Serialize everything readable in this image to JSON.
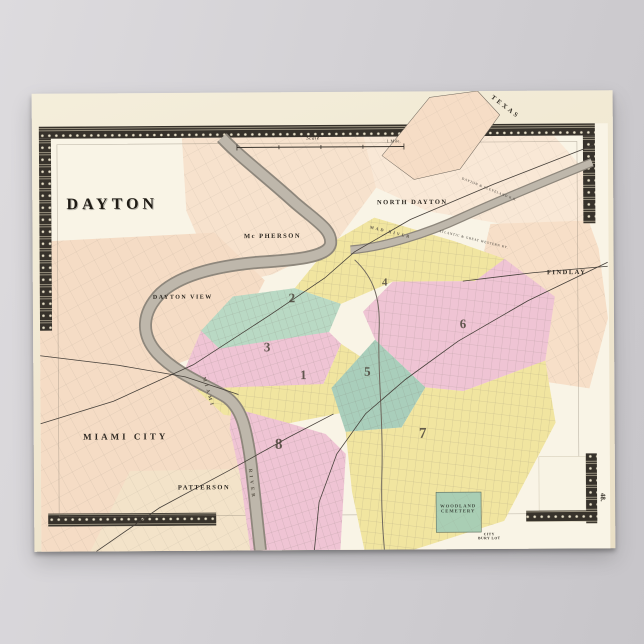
{
  "map": {
    "title": "DAYTON",
    "page_number": "48.",
    "scale": {
      "label": "Scale",
      "unit": "1 Mile."
    },
    "districts": {
      "mcpherson": "Mc PHERSON",
      "north_dayton": "NORTH DAYTON",
      "texas": "TEXAS",
      "findlay": "FINDLAY",
      "dayton_view": "DAYTON VIEW",
      "miami_city": "MIAMI CITY",
      "patterson": "PATTERSON",
      "woodland_cemetery": "WOODLAND CEMETERY",
      "city_bury_lot": "CITY BURY LOT"
    },
    "waterways": {
      "miami": "MIAMI",
      "river": "RIVER",
      "mad_river": "MAD RIVER"
    },
    "railroads": {
      "dayton_cleveland": "DAYTON & CLEVELAND R.R.",
      "atlantic_great_western": "ATLANTIC & GREAT WESTERN RY."
    },
    "wards": [
      {
        "number": "1"
      },
      {
        "number": "2"
      },
      {
        "number": "3"
      },
      {
        "number": "4"
      },
      {
        "number": "5"
      },
      {
        "number": "6"
      },
      {
        "number": "7"
      },
      {
        "number": "8"
      }
    ],
    "colors": {
      "ward_yellow": "#f1e5a0",
      "ward_pink": "#efc4d4",
      "ward_green": "#b9d9c4",
      "outskirts_salmon": "#f6dcc4",
      "cemetery_green": "#a9ceb4",
      "river_gray": "#beb7ab",
      "paper_cream": "#f1e9d3",
      "border_ink": "#37322b",
      "backdrop_gray": "#cfcdd1"
    }
  }
}
